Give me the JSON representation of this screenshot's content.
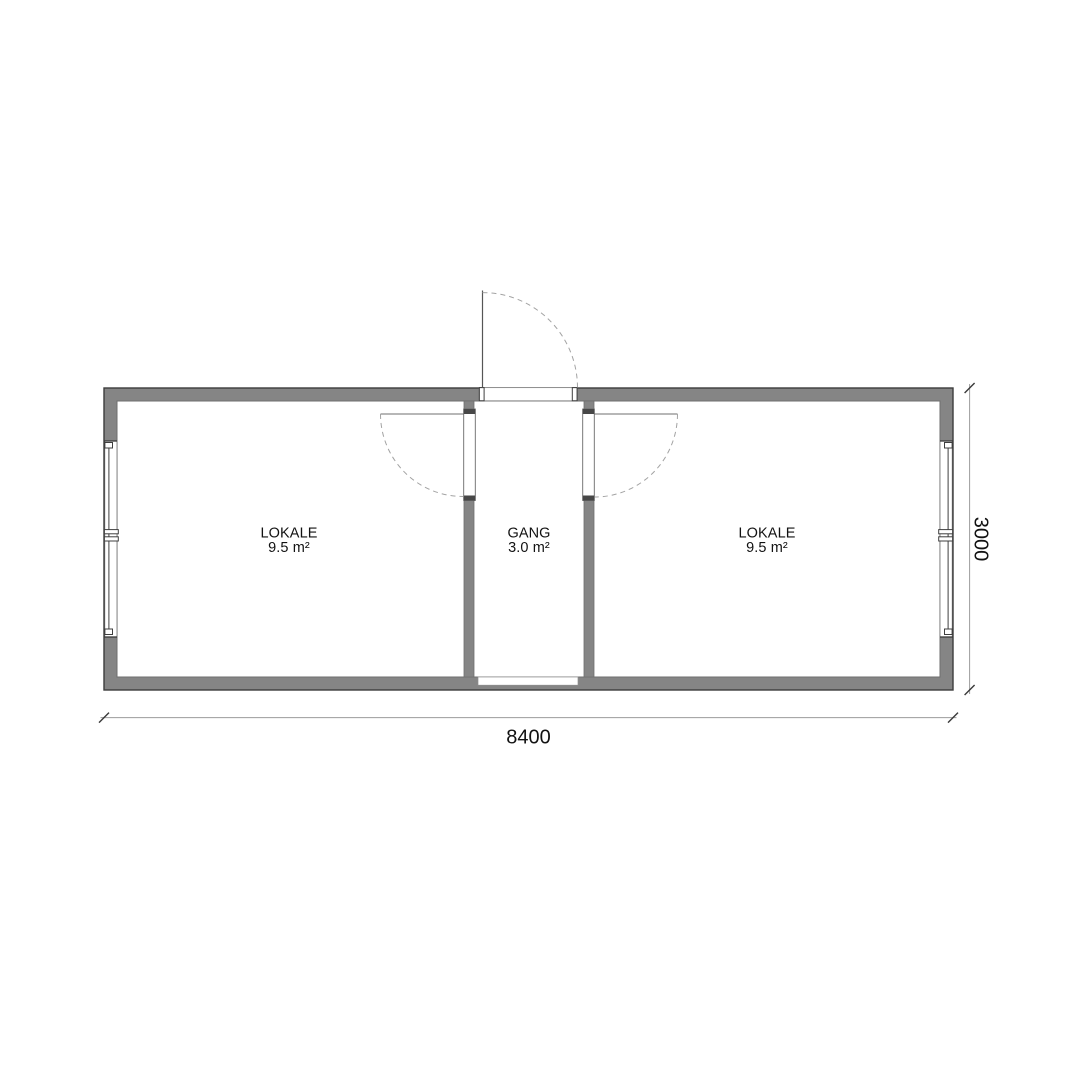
{
  "plan": {
    "title": "container-floor-plan",
    "rooms": [
      {
        "name": "LOKALE",
        "area": "9.5 m²"
      },
      {
        "name": "GANG",
        "area": "3.0 m²"
      },
      {
        "name": "LOKALE",
        "area": "9.5 m²"
      }
    ],
    "dimensions": {
      "width_label": "8400",
      "height_label": "3000"
    },
    "colors": {
      "background": "#ffffff",
      "wall": "#858585",
      "outline": "#3d3d3d",
      "inner_line": "#6e6e6e",
      "frame": "#3f3f3f",
      "jamb": "#474747",
      "leaf": "#6f6f6f",
      "dash": "#a3a3a3",
      "dim_line": "#9c9c9c",
      "dim_tick": "#3a3a3a",
      "text": "#121212"
    }
  }
}
